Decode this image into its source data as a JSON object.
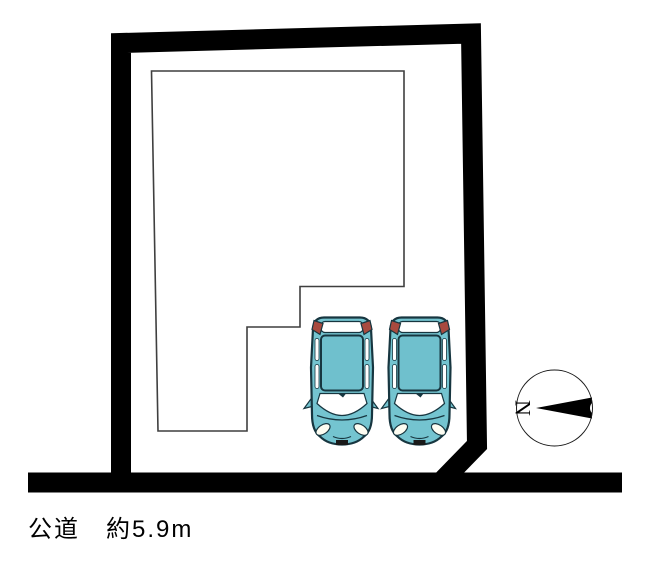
{
  "canvas": {
    "width_px": 653,
    "height_px": 564,
    "background": "#ffffff"
  },
  "road": {
    "label_full": "公道　約5.9m",
    "type": "公道",
    "width": "約5.9m"
  },
  "compass": {
    "north_label": "N",
    "north_points": "left"
  },
  "parking": {
    "car_count": 2
  },
  "colors": {
    "boundary": "#000000",
    "building_outline": "#3f3f3f",
    "building_fill": "#ffffff",
    "car_body": "#74c4d0",
    "car_roof": "#6fc0cd",
    "car_outline": "#173640",
    "car_glass": "#ffffff",
    "car_taillight": "#a84a3f",
    "compass_ring": "#1a1a1a",
    "compass_arrow": "#000000",
    "label_text": "#000000"
  }
}
